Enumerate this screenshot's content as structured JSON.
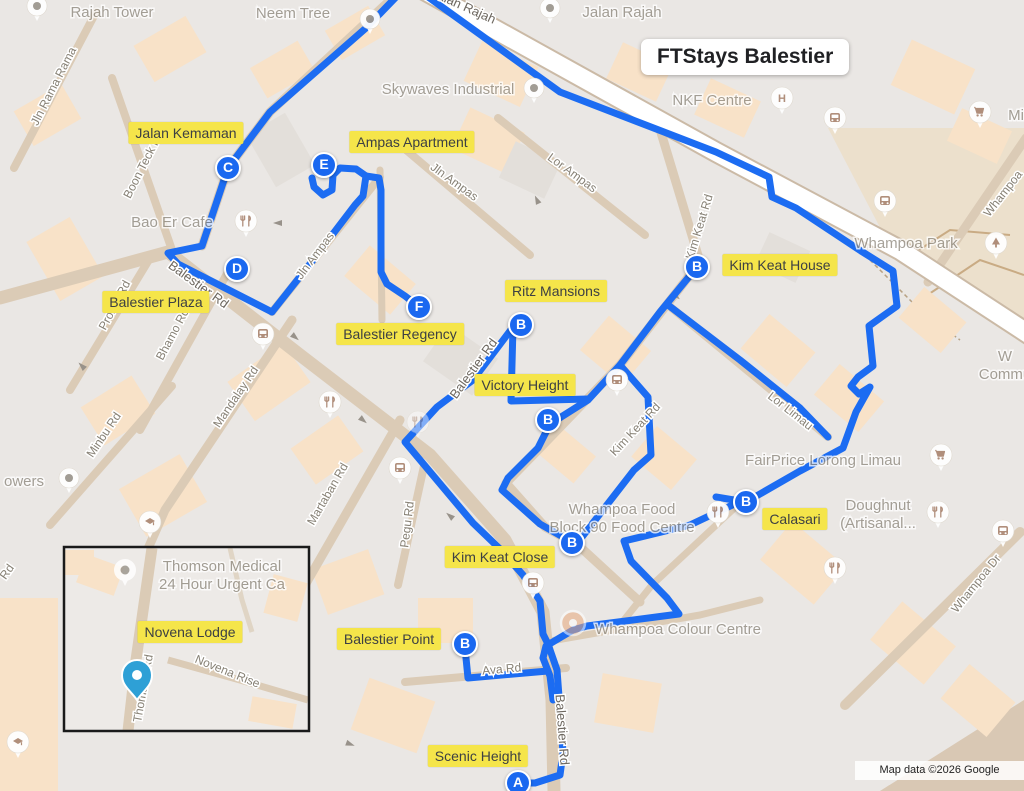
{
  "title": "FTStays Balestier",
  "attribution": "Map data ©2026 Google",
  "colors": {
    "route": "#1c6cf2",
    "marker": "#1a68f0",
    "label_bg": "#f5e54a",
    "land": "#eae7e4",
    "building": "#f8e2c8",
    "road": "#dbcbb6",
    "main_road": "#ffffff",
    "park": "#ece0cc",
    "inset_pin": "#2ea0d6",
    "poi_glyph": "#ad8a76"
  },
  "markers": [
    {
      "letter": "C",
      "x": 228,
      "y": 168
    },
    {
      "letter": "E",
      "x": 324,
      "y": 165
    },
    {
      "letter": "D",
      "x": 237,
      "y": 269
    },
    {
      "letter": "F",
      "x": 419,
      "y": 307
    },
    {
      "letter": "B",
      "x": 521,
      "y": 325
    },
    {
      "letter": "B",
      "x": 697,
      "y": 267
    },
    {
      "letter": "B",
      "x": 548,
      "y": 420
    },
    {
      "letter": "B",
      "x": 572,
      "y": 543
    },
    {
      "letter": "B",
      "x": 746,
      "y": 502
    },
    {
      "letter": "B",
      "x": 465,
      "y": 644
    },
    {
      "letter": "A",
      "x": 518,
      "y": 783
    }
  ],
  "property_labels": [
    {
      "text": "Jalan Kemaman",
      "x": 186,
      "y": 133
    },
    {
      "text": "Ampas Apartment",
      "x": 412,
      "y": 142
    },
    {
      "text": "Balestier Plaza",
      "x": 156,
      "y": 302
    },
    {
      "text": "Balestier Regency",
      "x": 400,
      "y": 334
    },
    {
      "text": "Ritz Mansions",
      "x": 556,
      "y": 291
    },
    {
      "text": "Kim Keat House",
      "x": 780,
      "y": 265
    },
    {
      "text": "Victory Height",
      "x": 525,
      "y": 385
    },
    {
      "text": "Kim Keat Close",
      "x": 500,
      "y": 557
    },
    {
      "text": "Calasari",
      "x": 795,
      "y": 519
    },
    {
      "text": "Balestier Point",
      "x": 389,
      "y": 639
    },
    {
      "text": "Novena Lodge",
      "x": 190,
      "y": 632
    },
    {
      "text": "Scenic Height",
      "x": 478,
      "y": 756
    }
  ],
  "poi_labels": [
    {
      "lines": [
        "Rajah Tower"
      ],
      "x": 112,
      "y": 13
    },
    {
      "lines": [
        "Neem Tree"
      ],
      "x": 293,
      "y": 14
    },
    {
      "lines": [
        "Jalan Rajah"
      ],
      "x": 622,
      "y": 13
    },
    {
      "lines": [
        "Skywaves Industrial"
      ],
      "x": 448,
      "y": 90
    },
    {
      "lines": [
        "NKF Centre"
      ],
      "x": 712,
      "y": 101
    },
    {
      "lines": [
        "Bao Er Cafe"
      ],
      "x": 172,
      "y": 223
    },
    {
      "lines": [
        "Whampoa Park"
      ],
      "x": 906,
      "y": 244
    },
    {
      "lines": [
        "FairPrice Lorong Limau"
      ],
      "x": 823,
      "y": 461
    },
    {
      "lines": [
        "Doughnut",
        "(Artisanal..."
      ],
      "x": 878,
      "y": 506
    },
    {
      "lines": [
        "Whampoa Food",
        "Block 90 Food Centre"
      ],
      "x": 622,
      "y": 510
    },
    {
      "lines": [
        "Whampoa Colour Centre"
      ],
      "x": 678,
      "y": 630
    },
    {
      "lines": [
        "owers"
      ],
      "x": 24,
      "y": 482
    },
    {
      "lines": [
        "Mi"
      ],
      "x": 1016,
      "y": 116
    },
    {
      "lines": [
        "W",
        "Commu"
      ],
      "x": 1005,
      "y": 357
    }
  ],
  "road_labels": [
    {
      "text": "Jalan Rajah",
      "x": 462,
      "y": 10,
      "rot": 24,
      "main": true
    },
    {
      "text": "Jln Rama Rama",
      "x": 57,
      "y": 88,
      "rot": -63
    },
    {
      "text": "Boon Teck Rd",
      "x": 147,
      "y": 166,
      "rot": -63
    },
    {
      "text": "Balestier Rd",
      "x": 196,
      "y": 288,
      "rot": 36,
      "main": true
    },
    {
      "text": "Balestier Rd",
      "x": 477,
      "y": 371,
      "rot": -54,
      "main": true
    },
    {
      "text": "Balestier Rd",
      "x": 558,
      "y": 730,
      "rot": 86,
      "main": true
    },
    {
      "text": "Prome Rd",
      "x": 118,
      "y": 307,
      "rot": -62
    },
    {
      "text": "Bhamo Rd",
      "x": 176,
      "y": 336,
      "rot": -62
    },
    {
      "text": "Mandalay Rd",
      "x": 239,
      "y": 399,
      "rot": -56
    },
    {
      "text": "Minbu Rd",
      "x": 107,
      "y": 437,
      "rot": -56
    },
    {
      "text": "Martaban Rd",
      "x": 331,
      "y": 496,
      "rot": -60
    },
    {
      "text": "Pegu Rd",
      "x": 411,
      "y": 525,
      "rot": -83
    },
    {
      "text": "Jln Ampas",
      "x": 318,
      "y": 258,
      "rot": -53
    },
    {
      "text": "Jln Ampas",
      "x": 452,
      "y": 185,
      "rot": 36
    },
    {
      "text": "Lor Ampas",
      "x": 570,
      "y": 176,
      "rot": 36
    },
    {
      "text": "Kim Keat Rd",
      "x": 703,
      "y": 228,
      "rot": -73
    },
    {
      "text": "Kim Keat Rd",
      "x": 638,
      "y": 432,
      "rot": -47
    },
    {
      "text": "Lor Limau",
      "x": 788,
      "y": 414,
      "rot": 38
    },
    {
      "text": "Whampoa Dr",
      "x": 979,
      "y": 586,
      "rot": -51
    },
    {
      "text": "Whampoa",
      "x": 1006,
      "y": 196,
      "rot": -52
    },
    {
      "text": "Ava Rd",
      "x": 502,
      "y": 673,
      "rot": -5
    },
    {
      "text": "Rd",
      "x": 10,
      "y": 574,
      "rot": -55
    }
  ],
  "pois": [
    {
      "type": "restaurant",
      "x": 246,
      "y": 221
    },
    {
      "type": "restaurant",
      "x": 330,
      "y": 402
    },
    {
      "type": "restaurant",
      "x": 418,
      "y": 422,
      "faded": true
    },
    {
      "type": "restaurant",
      "x": 718,
      "y": 512
    },
    {
      "type": "restaurant",
      "x": 938,
      "y": 512
    },
    {
      "type": "restaurant",
      "x": 835,
      "y": 568
    },
    {
      "type": "cart",
      "x": 941,
      "y": 455
    },
    {
      "type": "cart",
      "x": 980,
      "y": 112
    },
    {
      "type": "bus",
      "x": 835,
      "y": 118
    },
    {
      "type": "bus",
      "x": 885,
      "y": 201
    },
    {
      "type": "bus",
      "x": 263,
      "y": 334
    },
    {
      "type": "bus",
      "x": 400,
      "y": 468
    },
    {
      "type": "bus",
      "x": 533,
      "y": 583
    },
    {
      "type": "bus",
      "x": 617,
      "y": 380
    },
    {
      "type": "bus",
      "x": 1003,
      "y": 531
    },
    {
      "type": "hospital",
      "x": 782,
      "y": 98
    },
    {
      "type": "tree",
      "x": 996,
      "y": 243
    },
    {
      "type": "school",
      "x": 150,
      "y": 522
    },
    {
      "type": "school",
      "x": 18,
      "y": 742
    },
    {
      "type": "dot",
      "x": 69,
      "y": 478
    },
    {
      "type": "dot",
      "x": 37,
      "y": 6
    },
    {
      "type": "dot",
      "x": 370,
      "y": 19
    },
    {
      "type": "dot",
      "x": 550,
      "y": 8
    },
    {
      "type": "dot",
      "x": 534,
      "y": 88
    },
    {
      "type": "colour",
      "x": 573,
      "y": 623
    }
  ],
  "routes": [
    "399,-6 366,28 270,112 228,168 202,246 168,253 178,264 272,312",
    "272,312 310,264 355,205 363,196 366,176 356,169 340,168 333,175 332,190 323,195 314,187 312,178",
    "366,176 379,178 381,190 381,272 387,284 405,296 418,306",
    "424,-6 560,92 716,152 769,177 772,197 796,208 861,251 893,271 897,306 869,326 873,366 858,377 851,386 859,394 870,387 856,412 843,448 800,471 746,502 716,497",
    "697,267 660,312 620,365 588,400 550,424 538,448 508,478 502,490 540,524 570,541",
    "668,305 740,360 800,408 828,437",
    "513,327 511,401 588,399",
    "513,327 473,380 437,407 405,442 473,523 500,549 523,575 540,601 543,634 548,644 557,670 560,710 563,753 560,775 535,783 518,783",
    "620,365 648,397 651,455 634,470 582,537",
    "743,500 690,525 645,536 624,541 631,561 667,598 679,614 587,626 573,630 546,646 543,658 550,676 553,700",
    "465,648 468,678 548,671"
  ],
  "inset": {
    "x": 64,
    "y": 547,
    "w": 245,
    "h": 184,
    "poi_label": {
      "lines": [
        "Thomson Medical",
        "24 Hour Urgent Ca"
      ],
      "x": 222,
      "y": 567
    },
    "road_labels": [
      {
        "text": "Thomson Rd",
        "x": 147,
        "y": 689,
        "rot": -80
      },
      {
        "text": "Novena Rise",
        "x": 226,
        "y": 675,
        "rot": 22
      }
    ],
    "location_pin": {
      "x": 137,
      "y": 700
    },
    "poi_pin": {
      "x": 125,
      "y": 570
    }
  }
}
